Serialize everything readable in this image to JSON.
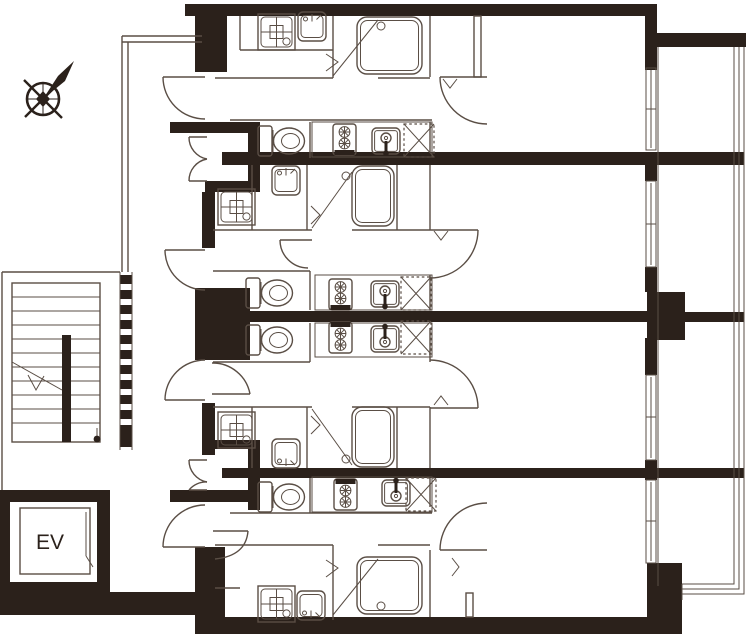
{
  "page": {
    "title": "Apartment building floor plan",
    "type": "architectural-floor-plan"
  },
  "labels": {
    "elevator": "EV"
  },
  "colors": {
    "wall": "#2b211b",
    "line": "#5a4e45",
    "background": "#ffffff"
  },
  "compass": {
    "description": "compass rose with needle pointing upper-right (north-east)"
  },
  "common_areas": [
    {
      "name": "staircase",
      "feature": "double-flight stair with break line and descent arrow, hatched party wall"
    },
    {
      "name": "elevator",
      "label": "EV",
      "position": "bottom-left shaft"
    },
    {
      "name": "corridor",
      "position": "open walkway along left side of units"
    },
    {
      "name": "balcony",
      "position": "right side, continuous with railing, divided by party walls"
    }
  ],
  "units": [
    {
      "id": "unit-1",
      "position": "top band",
      "fixtures": [
        "washing-machine-pan",
        "washbasin",
        "bathtub",
        "toilet",
        "gas-stove",
        "kitchen-sink",
        "appliance-space",
        "entry-door",
        "living-door",
        "balcony-window"
      ]
    },
    {
      "id": "unit-2",
      "position": "upper-middle band",
      "fixtures": [
        "washing-machine-pan",
        "washbasin",
        "bathtub",
        "toilet",
        "gas-stove",
        "kitchen-sink",
        "appliance-space",
        "entry-door",
        "hall-door",
        "living-door",
        "balcony-window"
      ]
    },
    {
      "id": "unit-3",
      "position": "lower-middle band",
      "fixtures": [
        "washing-machine-pan",
        "washbasin",
        "bathtub",
        "toilet",
        "gas-stove",
        "kitchen-sink",
        "appliance-space",
        "entry-door",
        "hall-door",
        "living-door",
        "balcony-window"
      ]
    },
    {
      "id": "unit-4",
      "position": "bottom band",
      "fixtures": [
        "washing-machine-pan",
        "washbasin",
        "bathtub",
        "toilet",
        "gas-stove",
        "kitchen-sink",
        "appliance-space",
        "entry-door",
        "living-door",
        "balcony-window"
      ]
    }
  ]
}
